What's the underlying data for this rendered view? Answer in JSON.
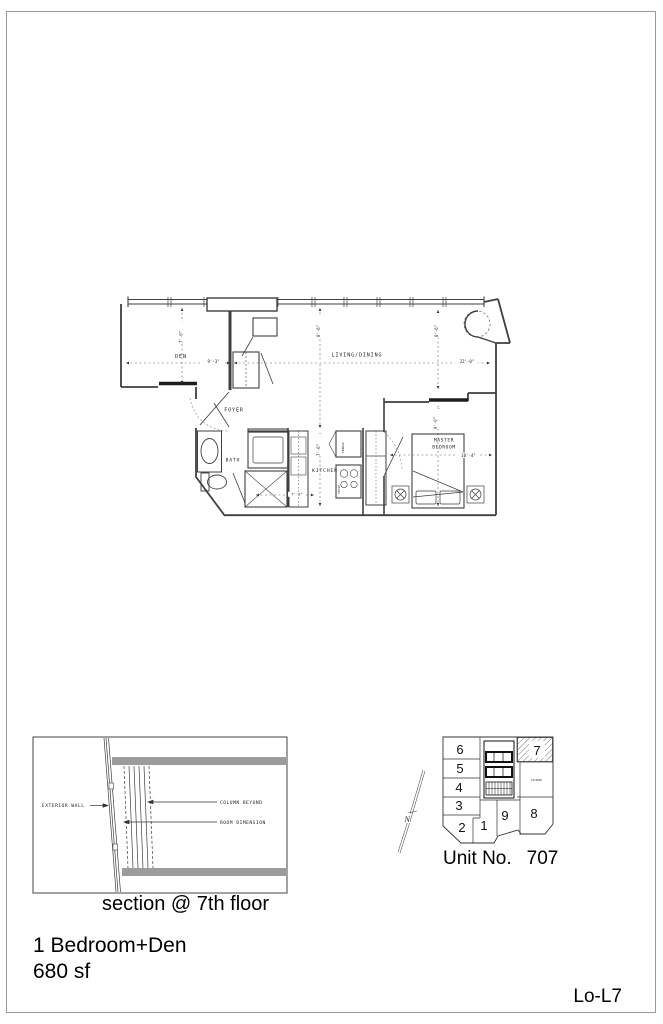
{
  "page": {
    "unit_type": "1 Bedroom+Den",
    "area": "680 sf",
    "sheet_code": "Lo-L7",
    "colors": {
      "border": "#9a9a9a",
      "slab_gray": "#9c9c9c",
      "line": "#3f3f3f"
    }
  },
  "floor_plan": {
    "rooms": {
      "den": "DEN",
      "living_dining": "LIVING/DINING",
      "foyer": "FOYER",
      "bath": "BATH",
      "kitchen": "KITCHEN",
      "master_line1": "MASTER",
      "master_line2": "BEDROOM"
    },
    "appliances": {
      "fridge": "FRIDGE",
      "stove": "STOVE"
    },
    "dims": {
      "den_width": "9'-3\"",
      "den_depth": "7'-0\"",
      "living_width": "22'-0\"",
      "living_depth_left": "8'-6\"",
      "living_depth_right": "8'-6\"",
      "kitchen_depth": "7'-6\"",
      "bath_width": "7'-0\"",
      "bedroom_width": "10'-4\"",
      "bedroom_depth": "9'-0\""
    }
  },
  "section_detail": {
    "caption": "section @ 7th floor",
    "labels": {
      "exterior_wall": "EXTERIOR WALL",
      "column_beyond": "COLUMN BEYOND",
      "room_dimension": "ROOM DIMENSION"
    }
  },
  "key_plan": {
    "caption_label": "Unit No.",
    "caption_number": "707",
    "north": "N",
    "lockers": "LOCKERS",
    "highlighted_unit": "7",
    "units": {
      "u1": "1",
      "u2": "2",
      "u3": "3",
      "u4": "4",
      "u5": "5",
      "u6": "6",
      "u7": "7",
      "u8": "8",
      "u9": "9"
    }
  }
}
